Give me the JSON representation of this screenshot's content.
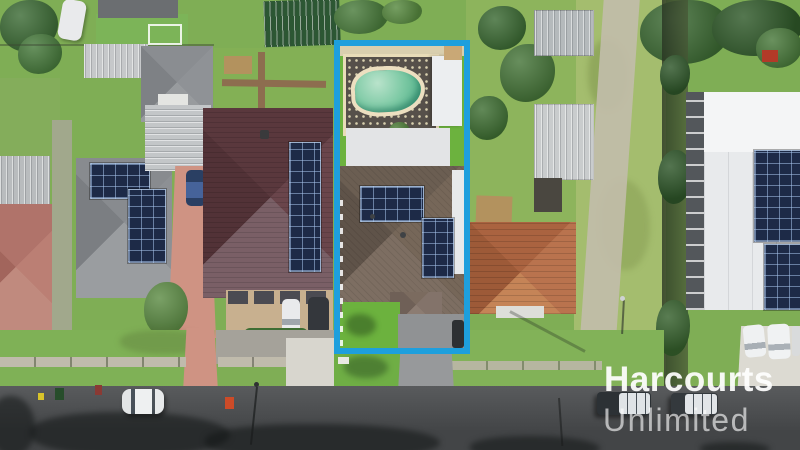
{
  "scene": {
    "kind": "aerial-photograph",
    "subject": "Suburban street, top-down drone view with a blue outline highlighting the listed property (pool, solar-panel roof, driveway)"
  },
  "watermark": {
    "brand": "Harcourts",
    "division": "Unlimited"
  },
  "highlight": {
    "border_color": "#1e9fdd"
  },
  "palette": {
    "boundary_blue": "#1e9fdd",
    "grass_mid": "#7fae55",
    "grass_bright": "#6cb23e",
    "grass_pale": "#a4bd6e",
    "road_asphalt": "#4e5052",
    "roof_maroon": "#5e3c41",
    "roof_grey": "#85888c",
    "roof_taupe": "#6e6055",
    "roof_terracotta": "#b06a48",
    "roof_white": "#eceef0",
    "roof_green": "#2c5733",
    "solar_panel": "#1d2a47",
    "pool_water": "#7cc9a4",
    "pool_coping": "#e8dcb8",
    "paving_salmon": "#cf9383",
    "concrete_path": "#c2bcab",
    "foliage": "#3f6f33"
  }
}
